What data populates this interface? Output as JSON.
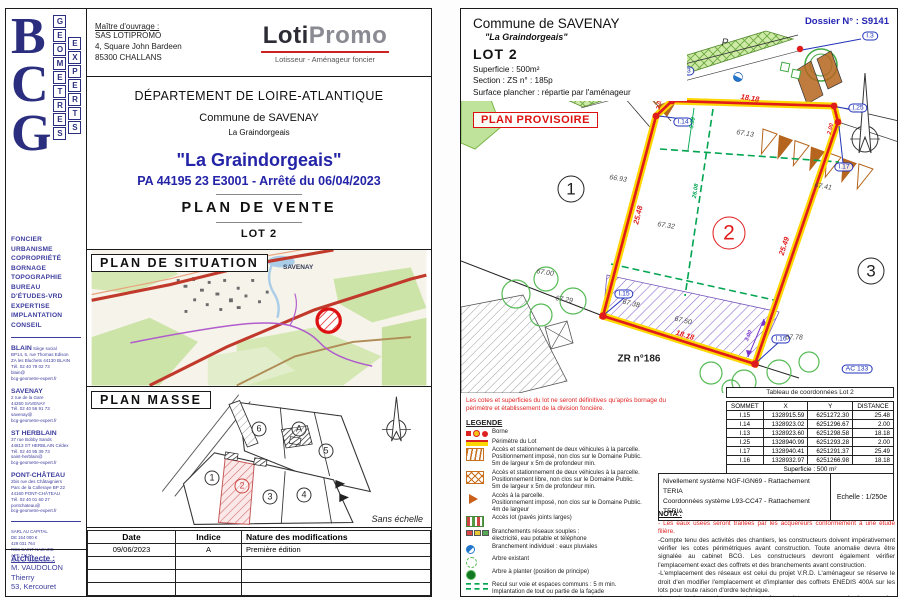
{
  "left_page": {
    "sidebar": {
      "logo_big": [
        "B",
        "C",
        "G"
      ],
      "logo_col1": [
        "G",
        "E",
        "O",
        "M",
        "E",
        "T",
        "R",
        "E",
        "S"
      ],
      "logo_col2": [
        "E",
        "X",
        "P",
        "E",
        "R",
        "T",
        "S"
      ],
      "services": [
        "FONCIER",
        "URBANISME",
        "COPROPRIÉTÉ",
        "BORNAGE",
        "TOPOGRAPHIE",
        "BUREAU",
        " D'ÉTUDES-VRD",
        "EXPERTISE",
        "IMPLANTATION",
        "CONSEIL"
      ],
      "offices": [
        {
          "name": "BLAIN",
          "suffix": "Siège social",
          "lines": [
            "BP14, 5, rue Thomas Edison",
            "ZA les Bluchets 44130 BLAIN",
            "Tél. 02 40 79 02 73",
            "blain@",
            "bcg-geometre-expert.fr"
          ]
        },
        {
          "name": "SAVENAY",
          "suffix": "",
          "lines": [
            "2 rue de la Gare",
            "44260 SAVENAY",
            "Tél. 02 40 56 91 73",
            "savenay@",
            "bcg-geometre-expert.fr"
          ]
        },
        {
          "name": "ST HERBLAIN",
          "suffix": "",
          "lines": [
            "37 rue Bobby Sands",
            "44813 ST HERBLAIN Cédex",
            "Tél. 02 40 95 39 73",
            "saint-herblain@",
            "bcg-geometre-expert.fr"
          ]
        },
        {
          "name": "PONT-CHÂTEAU",
          "suffix": "",
          "lines": [
            "2bis rue des Châtaigniers",
            "Parc de la Colleraye BP 22",
            "44160 PONT-CHÂTEAU",
            "Tél. 02 40 01 60 27",
            "pontchateau@",
            "bcg-geometre-expert.fr"
          ]
        }
      ],
      "company": [
        "SARL AU CAPITAL",
        "DE 154 000 €",
        "429 031 764",
        "RCS SAINT-NAZAIRE",
        "APE 7112A",
        "OGE N° 2009E200310"
      ],
      "architect_label": "Architecte :",
      "architect_lines": [
        "M. VAUDOLON Thierry",
        "53, Kercouret"
      ]
    },
    "header": {
      "client_label": "Maître d'ouvrage :",
      "client_lines": [
        "SAS LOTIPROMO",
        "4, Square John Bardeen",
        "85300 CHALLANS"
      ],
      "logo_bold": "Loti",
      "logo_light": "Promo",
      "tagline": "Lotisseur - Aménageur foncier"
    },
    "titles": {
      "dept": "DÉPARTEMENT DE LOIRE-ATLANTIQUE",
      "commune": "Commune de SAVENAY",
      "place": "La Graindorgeais",
      "big": "\"La Graindorgeais\"",
      "pa": "PA 44195 23 E3001 - Arrêté du 06/04/2023",
      "plan": "PLAN  DE  VENTE",
      "lot": "LOT 2"
    },
    "situation": {
      "title": "PLAN  DE  SITUATION",
      "town": "SAVENAY"
    },
    "masse": {
      "title": "PLAN  MASSE",
      "scale_note": "Sans échelle",
      "lots": [
        {
          "t": "1",
          "x": 125,
          "y": 91,
          "red": false
        },
        {
          "t": "2",
          "x": 155,
          "y": 99,
          "red": true
        },
        {
          "t": "3",
          "x": 183,
          "y": 110,
          "red": false
        },
        {
          "t": "4",
          "x": 217,
          "y": 108,
          "red": false
        },
        {
          "t": "5",
          "x": 239,
          "y": 64,
          "red": false
        },
        {
          "t": "6",
          "x": 172,
          "y": 42,
          "red": false
        },
        {
          "t": "A",
          "x": 212,
          "y": 42,
          "red": false
        }
      ]
    },
    "mod_table": {
      "headers": [
        "Date",
        "Indice",
        "Nature des modifications"
      ],
      "rows": [
        [
          "09/06/2023",
          "A",
          "Première édition"
        ],
        [
          "",
          "",
          ""
        ],
        [
          "",
          "",
          ""
        ],
        [
          "",
          "",
          ""
        ]
      ]
    }
  },
  "right_page": {
    "header": {
      "commune": "Commune de SAVENAY",
      "place": "\"La Graindorgeais\"",
      "lot": "LOT 2",
      "superficie": "Superficie :  500m²",
      "section": "Section : ZS     n° : 185p",
      "surface": "Surface plancher : répartie par l'aménageur",
      "dossier": "Dossier N° : S9141",
      "provisoire": "PLAN PROVISOIRE"
    },
    "plot_labels": [
      {
        "t": "I.3",
        "x": 409,
        "y": 27,
        "r": 0,
        "c": "pl-som"
      },
      {
        "t": "I.13",
        "x": 224,
        "y": 62,
        "r": 0,
        "c": "pl-som"
      },
      {
        "t": "I.14",
        "x": 222,
        "y": 113,
        "r": 0,
        "c": "pl-som"
      },
      {
        "t": "I.25",
        "x": 397,
        "y": 99,
        "r": 0,
        "c": "pl-som"
      },
      {
        "t": "I.17",
        "x": 383,
        "y": 158,
        "r": 0,
        "c": "pl-som"
      },
      {
        "t": "I.15",
        "x": 163,
        "y": 285,
        "r": 0,
        "c": "pl-som"
      },
      {
        "t": "I.16",
        "x": 320,
        "y": 330,
        "r": 0,
        "c": "pl-som"
      },
      {
        "t": "AC 133",
        "x": 396,
        "y": 360,
        "r": 0,
        "c": "pl-som"
      },
      {
        "t": "1",
        "x": 110,
        "y": 180,
        "r": 0,
        "c": "pl-lot"
      },
      {
        "t": "2",
        "x": 268,
        "y": 224,
        "r": 0,
        "c": "pl-lot pl-lot2"
      },
      {
        "t": "3",
        "x": 410,
        "y": 262,
        "r": 0,
        "c": "pl-lot"
      },
      {
        "t": "ZR n°186",
        "x": 178,
        "y": 350,
        "r": 0,
        "c": "pl-zr"
      },
      {
        "t": "P",
        "x": 264,
        "y": 34,
        "r": 0,
        "c": "pl-pzone"
      },
      {
        "t": "18.18",
        "x": 289,
        "y": 89,
        "r": 9,
        "c": "pl-red"
      },
      {
        "t": "25.48",
        "x": 177,
        "y": 206,
        "r": -76,
        "c": "pl-red"
      },
      {
        "t": "25.49",
        "x": 323,
        "y": 237,
        "r": -72,
        "c": "pl-red"
      },
      {
        "t": "18.18",
        "x": 224,
        "y": 326,
        "r": 17,
        "c": "pl-red"
      },
      {
        "t": "2.00",
        "x": 199,
        "y": 95,
        "r": -76,
        "c": "pl-red pl-sm"
      },
      {
        "t": "2.00",
        "x": 370,
        "y": 120,
        "r": -76,
        "c": "pl-red pl-sm"
      },
      {
        "t": "5.60",
        "x": 232,
        "y": 114,
        "r": -80,
        "c": "pl-green pl-sm"
      },
      {
        "t": "26.08",
        "x": 235,
        "y": 182,
        "r": -81,
        "c": "pl-green pl-sm"
      },
      {
        "t": "67.13",
        "x": 284,
        "y": 125,
        "r": 9,
        "c": "pl-dim"
      },
      {
        "t": "66.93",
        "x": 157,
        "y": 170,
        "r": 9,
        "c": "pl-dim"
      },
      {
        "t": "67.32",
        "x": 205,
        "y": 217,
        "r": 9,
        "c": "pl-dim"
      },
      {
        "t": "67.41",
        "x": 362,
        "y": 178,
        "r": 9,
        "c": "pl-dim"
      },
      {
        "t": "67.29",
        "x": 103,
        "y": 291,
        "r": 9,
        "c": "pl-dim"
      },
      {
        "t": "67.00",
        "x": 84,
        "y": 264,
        "r": 9,
        "c": "pl-dim"
      },
      {
        "t": "67.38",
        "x": 170,
        "y": 295,
        "r": 14,
        "c": "pl-dim"
      },
      {
        "t": "67.50",
        "x": 222,
        "y": 312,
        "r": 14,
        "c": "pl-dim"
      },
      {
        "t": "67.78",
        "x": 333,
        "y": 329,
        "r": 0,
        "c": "pl-dim"
      },
      {
        "t": "3.00",
        "x": 288,
        "y": 327,
        "r": -68,
        "c": "pl-purple pl-sm"
      }
    ],
    "disclaimer": "Les cotes et superficies du lot ne seront définitives qu'après bornage du périmètre et établissement de la division foncière.",
    "legende": {
      "title": "LEGENDE",
      "items": [
        {
          "icon": "borne",
          "text": "Borne"
        },
        {
          "icon": "perim",
          "text": "Périmètre du Lot"
        },
        {
          "icon": "hatchv",
          "text": "Accès et stationnement de deux véhicules à la parcelle.\nPositionnement imposé, non clos sur le Domaine Public.\n5m de largeur x 5m de profondeur min."
        },
        {
          "icon": "hatchx",
          "text": "Accès et stationnement de deux véhicules à la parcelle.\nPositionnement libre, non clos sur le Domaine Public.\n5m de largeur x 5m de profondeur min."
        },
        {
          "icon": "arrow",
          "text": "Accès à la parcelle.\nPositionnement imposé, non clos sur le Domaine Public.\n4m de largeur"
        },
        {
          "icon": "paves",
          "text": "Accès lot (pavés joints larges)"
        },
        {
          "icon": "branch",
          "text": "Branchements réseaux souples :\nélectricité, eau potable et téléphone"
        },
        {
          "icon": "eaux",
          "text": "Branchement individuel : eaux pluviales"
        },
        {
          "icon": "arbre1",
          "text": "Arbre existant"
        },
        {
          "icon": "arbre2",
          "text": "Arbre à planter (position de principe)"
        },
        {
          "icon": "recul",
          "text": "Recul sur voie et espaces communs : 5 m min.\nImplantation de tout ou partie de la façade\nentre 5m et 20m par rapport à l'alignement."
        },
        {
          "icon": "zone",
          "text": "Zone non-aedificandi pour la préservation\ndes haies existantes (3m d'emprise)"
        }
      ]
    },
    "coord_table": {
      "title": "Tableau de coordonnées Lot 2",
      "headers": [
        "SOMMET",
        "X",
        "Y",
        "DISTANCE"
      ],
      "rows": [
        [
          "I.15",
          "1328915.59",
          "6251272.30",
          "25.48"
        ],
        [
          "I.14",
          "1328923.02",
          "6251296.67",
          "2.00"
        ],
        [
          "I.13",
          "1328923.60",
          "6251298.58",
          "18.18"
        ],
        [
          "I.25",
          "1328940.99",
          "6251293.28",
          "2.00"
        ],
        [
          "I.17",
          "1328940.41",
          "6251291.37",
          "25.49"
        ],
        [
          "I.16",
          "1328932.97",
          "6251266.98",
          "18.18"
        ]
      ],
      "footer": "Superficie : 500 m²"
    },
    "reference": {
      "line1": "Nivellement système NGF-IGN69 - Rattachement TERIA",
      "line2": "Coordonnées système L93-CC47  - Rattachement TERIA",
      "scale": "Echelle : 1/250e"
    },
    "nota": {
      "title": "NOTA :",
      "items": [
        {
          "red": true,
          "text": "- Les eaux usées seront traitées par les acquéreurs conformément à une étude filière."
        },
        {
          "red": false,
          "text": "-Compte tenu des activités des chantiers, les constructeurs doivent impérativement vérifier les cotes périmétriques avant construction. Toute anomalie devra être signalée au cabinet BCG. Les constructeurs devront également vérifier l'emplacement exact des coffrets et des branchements avant construction."
        },
        {
          "red": false,
          "text": "-L'emplacement des réseaux est celui du projet V.R.D. L'aménageur se réserve le droit d'en modifier l'emplacement et d'implanter des coffrets ENEDIS 400A sur les lots pour toute raison d'ordre technique."
        },
        {
          "red": false,
          "text": "-Les plantations existantes doivent être maintenues ou remplacées par des plantations équivalentes."
        },
        {
          "red": false,
          "text": "-Depuis le 1er octobre 2020, toute vente d'un terrain à bâtir se trouvant dans une zone à"
        }
      ]
    }
  }
}
